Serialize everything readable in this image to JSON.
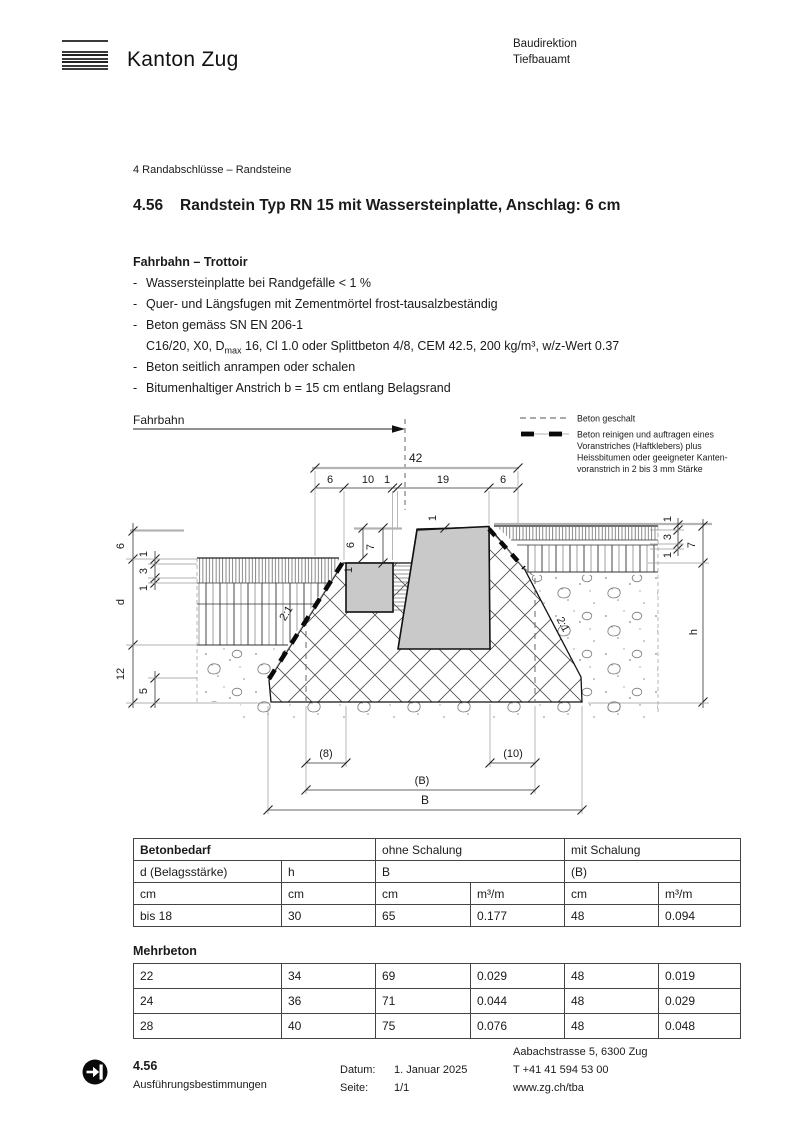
{
  "header": {
    "brand": "Kanton Zug",
    "org_line1": "Baudirektion",
    "org_line2": "Tiefbauamt"
  },
  "breadcrumb": "4 Randabschlüsse – Randsteine",
  "title": {
    "number": "4.56",
    "text": "Randstein Typ RN 15 mit Wassersteinplatte, Anschlag: 6 cm"
  },
  "section": {
    "heading": "Fahrbahn – Trottoir",
    "bullet_dash": "-",
    "bullets": [
      "Wassersteinplatte bei Randgefälle < 1 %",
      "Quer- und Längsfugen mit Zementmörtel frost-tausalzbeständig",
      "Beton gemäss SN EN 206-1"
    ],
    "beton_spec": {
      "pre": "C16/20, X0, D",
      "sub": "max",
      "post": " 16, Cl 1.0 oder Splittbeton 4/8, CEM 42.5, 200 kg/m³, w/z-Wert 0.37"
    },
    "bullets2": [
      "Beton seitlich anrampen oder schalen",
      "Bitumenhaltiger Anstrich b = 15 cm entlang Belagsrand"
    ]
  },
  "drawing": {
    "fahrbahn_label": "Fahrbahn",
    "legend": {
      "item1": "Beton geschalt",
      "item2_line1": "Beton reinigen und auftragen eines",
      "item2_line2": "Voranstriches (Haftklebers) plus",
      "item2_line3": "Heissbitumen oder geeigneter Kanten-",
      "item2_line4": "voranstrich in 2 bis 3 mm Stärke"
    },
    "dims": {
      "total": "42",
      "top": [
        "6",
        "10",
        "1",
        "19",
        "6"
      ],
      "left": [
        "6",
        "1",
        "3",
        "1",
        "d",
        "12",
        "5"
      ],
      "right": [
        "1",
        "3",
        "1",
        "7",
        "h"
      ],
      "plate": [
        "6",
        "7"
      ],
      "one_plate": "1",
      "one_stone": "1",
      "slope_left": "2:1",
      "slope_right": "2:1",
      "bottom": [
        "(8)",
        "(10)",
        "(B)",
        "B"
      ]
    }
  },
  "table1": {
    "title": "Betonbedarf",
    "group1": "ohne Schalung",
    "group2": "mit Schalung",
    "col1": "d (Belagsstärke)",
    "col2": "h",
    "col3": "B",
    "col4": "(B)",
    "units": [
      "cm",
      "cm",
      "cm",
      "m³/m",
      "cm",
      "m³/m"
    ],
    "row": [
      "bis 18",
      "30",
      "65",
      "0.177",
      "48",
      "0.094"
    ]
  },
  "table2": {
    "title": "Mehrbeton",
    "rows": [
      [
        "22",
        "34",
        "69",
        "0.029",
        "48",
        "0.019"
      ],
      [
        "24",
        "36",
        "71",
        "0.044",
        "48",
        "0.029"
      ],
      [
        "28",
        "40",
        "75",
        "0.076",
        "48",
        "0.048"
      ]
    ]
  },
  "footer": {
    "doc_number": "4.56",
    "doc_type": "Ausführungsbestimmungen",
    "date_label": "Datum:",
    "date": "1. Januar 2025",
    "page_label": "Seite:",
    "page": "1/1",
    "address": "Aabachstrasse 5, 6300 Zug",
    "phone": "T +41 41 594 53 00",
    "web": "www.zg.ch/tba"
  }
}
